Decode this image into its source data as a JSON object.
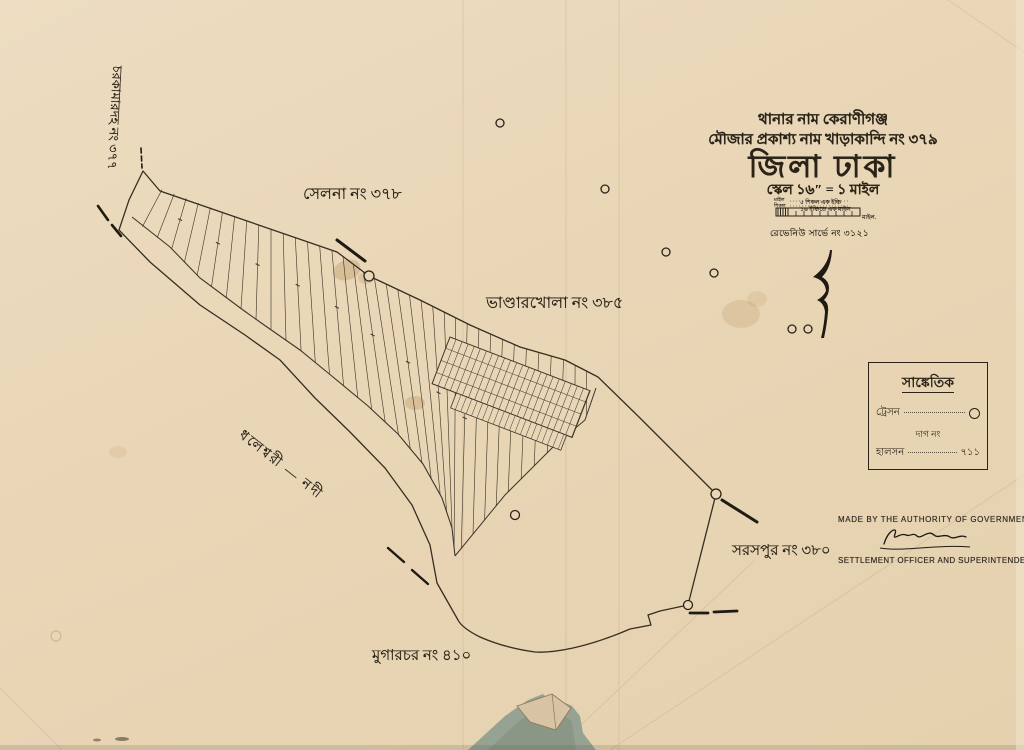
{
  "title_block": {
    "thana_line": "থানার নাম  কেরাণীগঞ্জ",
    "mouza_line": "মৌজার প্রকাশ্য নাম  খাড়াকান্দি নং ৩৭৯",
    "district_line": "জিলা ঢাকা",
    "scale_line": "স্কেল ১৬″ = ১ মাইল",
    "scale_note1": "৫ শিকল এক ইঞ্চি",
    "scale_note2": "১৬ ইঞ্চিতে এক মাইল",
    "scale_bar_left1": "মাইল",
    "scale_bar_left2": "শিকল",
    "scale_bar_right": "মাইল.",
    "revenue_line": "রেভেনিউ সার্ভে নং ৩১২১"
  },
  "map_labels": {
    "north_mouza": "সেলনা নং ৩৭৮",
    "east_mouza": "ভাণ্ডারখোলা নং ৩৮৫",
    "southeast_mouza": "সরসপুর নং ৩৮০",
    "south_mouza": "মুগারচর নং ৪১০",
    "west_mouza": "চরকামারদহ নং ৩৭৭",
    "river": "ধলেশ্বরী — নদী"
  },
  "legend": {
    "title": "সাঙ্কেতিক",
    "rows": [
      {
        "label": "ট্রেসন",
        "value": ""
      },
      {
        "label": "দাগ নং",
        "value": ""
      },
      {
        "label": "হালসন",
        "value": "৭১১"
      }
    ]
  },
  "footer": {
    "authority_line": "MADE BY THE AUTHORITY OF GOVERNMENT IN 1910-13",
    "officer_line": "SETTLEMENT OFFICER AND SUPERINTENDENT OF SURVEY"
  },
  "colors": {
    "paper": "#e9d6b6",
    "ink": "#2a2318",
    "line": "#3d362b",
    "tear_backing": "#96a292",
    "stain": "#a97e44"
  }
}
